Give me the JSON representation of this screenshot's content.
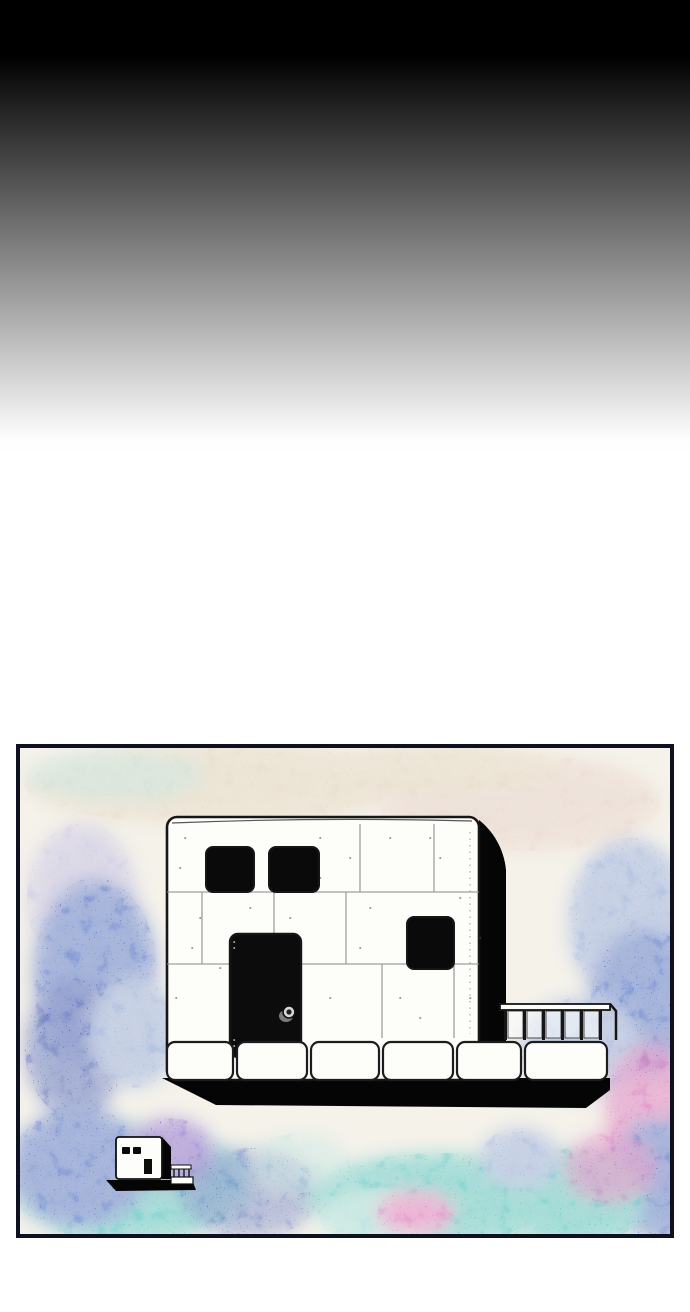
{
  "meta": {
    "description": "Vertical webtoon page: black-to-white gradient sky above a framed watercolor panel showing a white stone cube building with black windows, a black door with round knob, a right-side balcony railing, a ground shadow, and a tiny matching building at lower left."
  },
  "sky": {
    "top_color": "#000000",
    "bottom_color": "#ffffff"
  },
  "panel": {
    "border_color": "#0e1220",
    "base_color": "#f5f2ea"
  },
  "palette": {
    "ink": "#161616",
    "paper": "#fdfdfa",
    "stone_line": "#8e8e8e",
    "beige": "#e6d9c4",
    "beige_pink": "#e9d6cd",
    "lavender": "#c7c4e6",
    "light_blue": "#9db3e0",
    "blue": "#5d7bcd",
    "deep_blue": "#3c55b5",
    "teal": "#5fcac8",
    "aqua": "#a9e2e0",
    "magenta": "#d55cb4",
    "purple": "#8a6fd0",
    "pink": "#e47ec4",
    "shadow": "#050505",
    "window": "#0a0a0a",
    "door": "#0c0c0c",
    "knob_light": "#d6d6d6",
    "knob_dark": "#1f1f1f",
    "knob_halo": "#8f8f8f",
    "door_dash": "#a0a0a0",
    "glass": "rgba(255,255,255,0.5)"
  },
  "scene": {
    "large_building": {
      "window_count": 3,
      "door_count": 1,
      "has_doorknob": true,
      "railing_panel_count": 5,
      "stone_row_count": 6
    },
    "small_building": {
      "window_count": 2,
      "door_count": 1
    }
  }
}
